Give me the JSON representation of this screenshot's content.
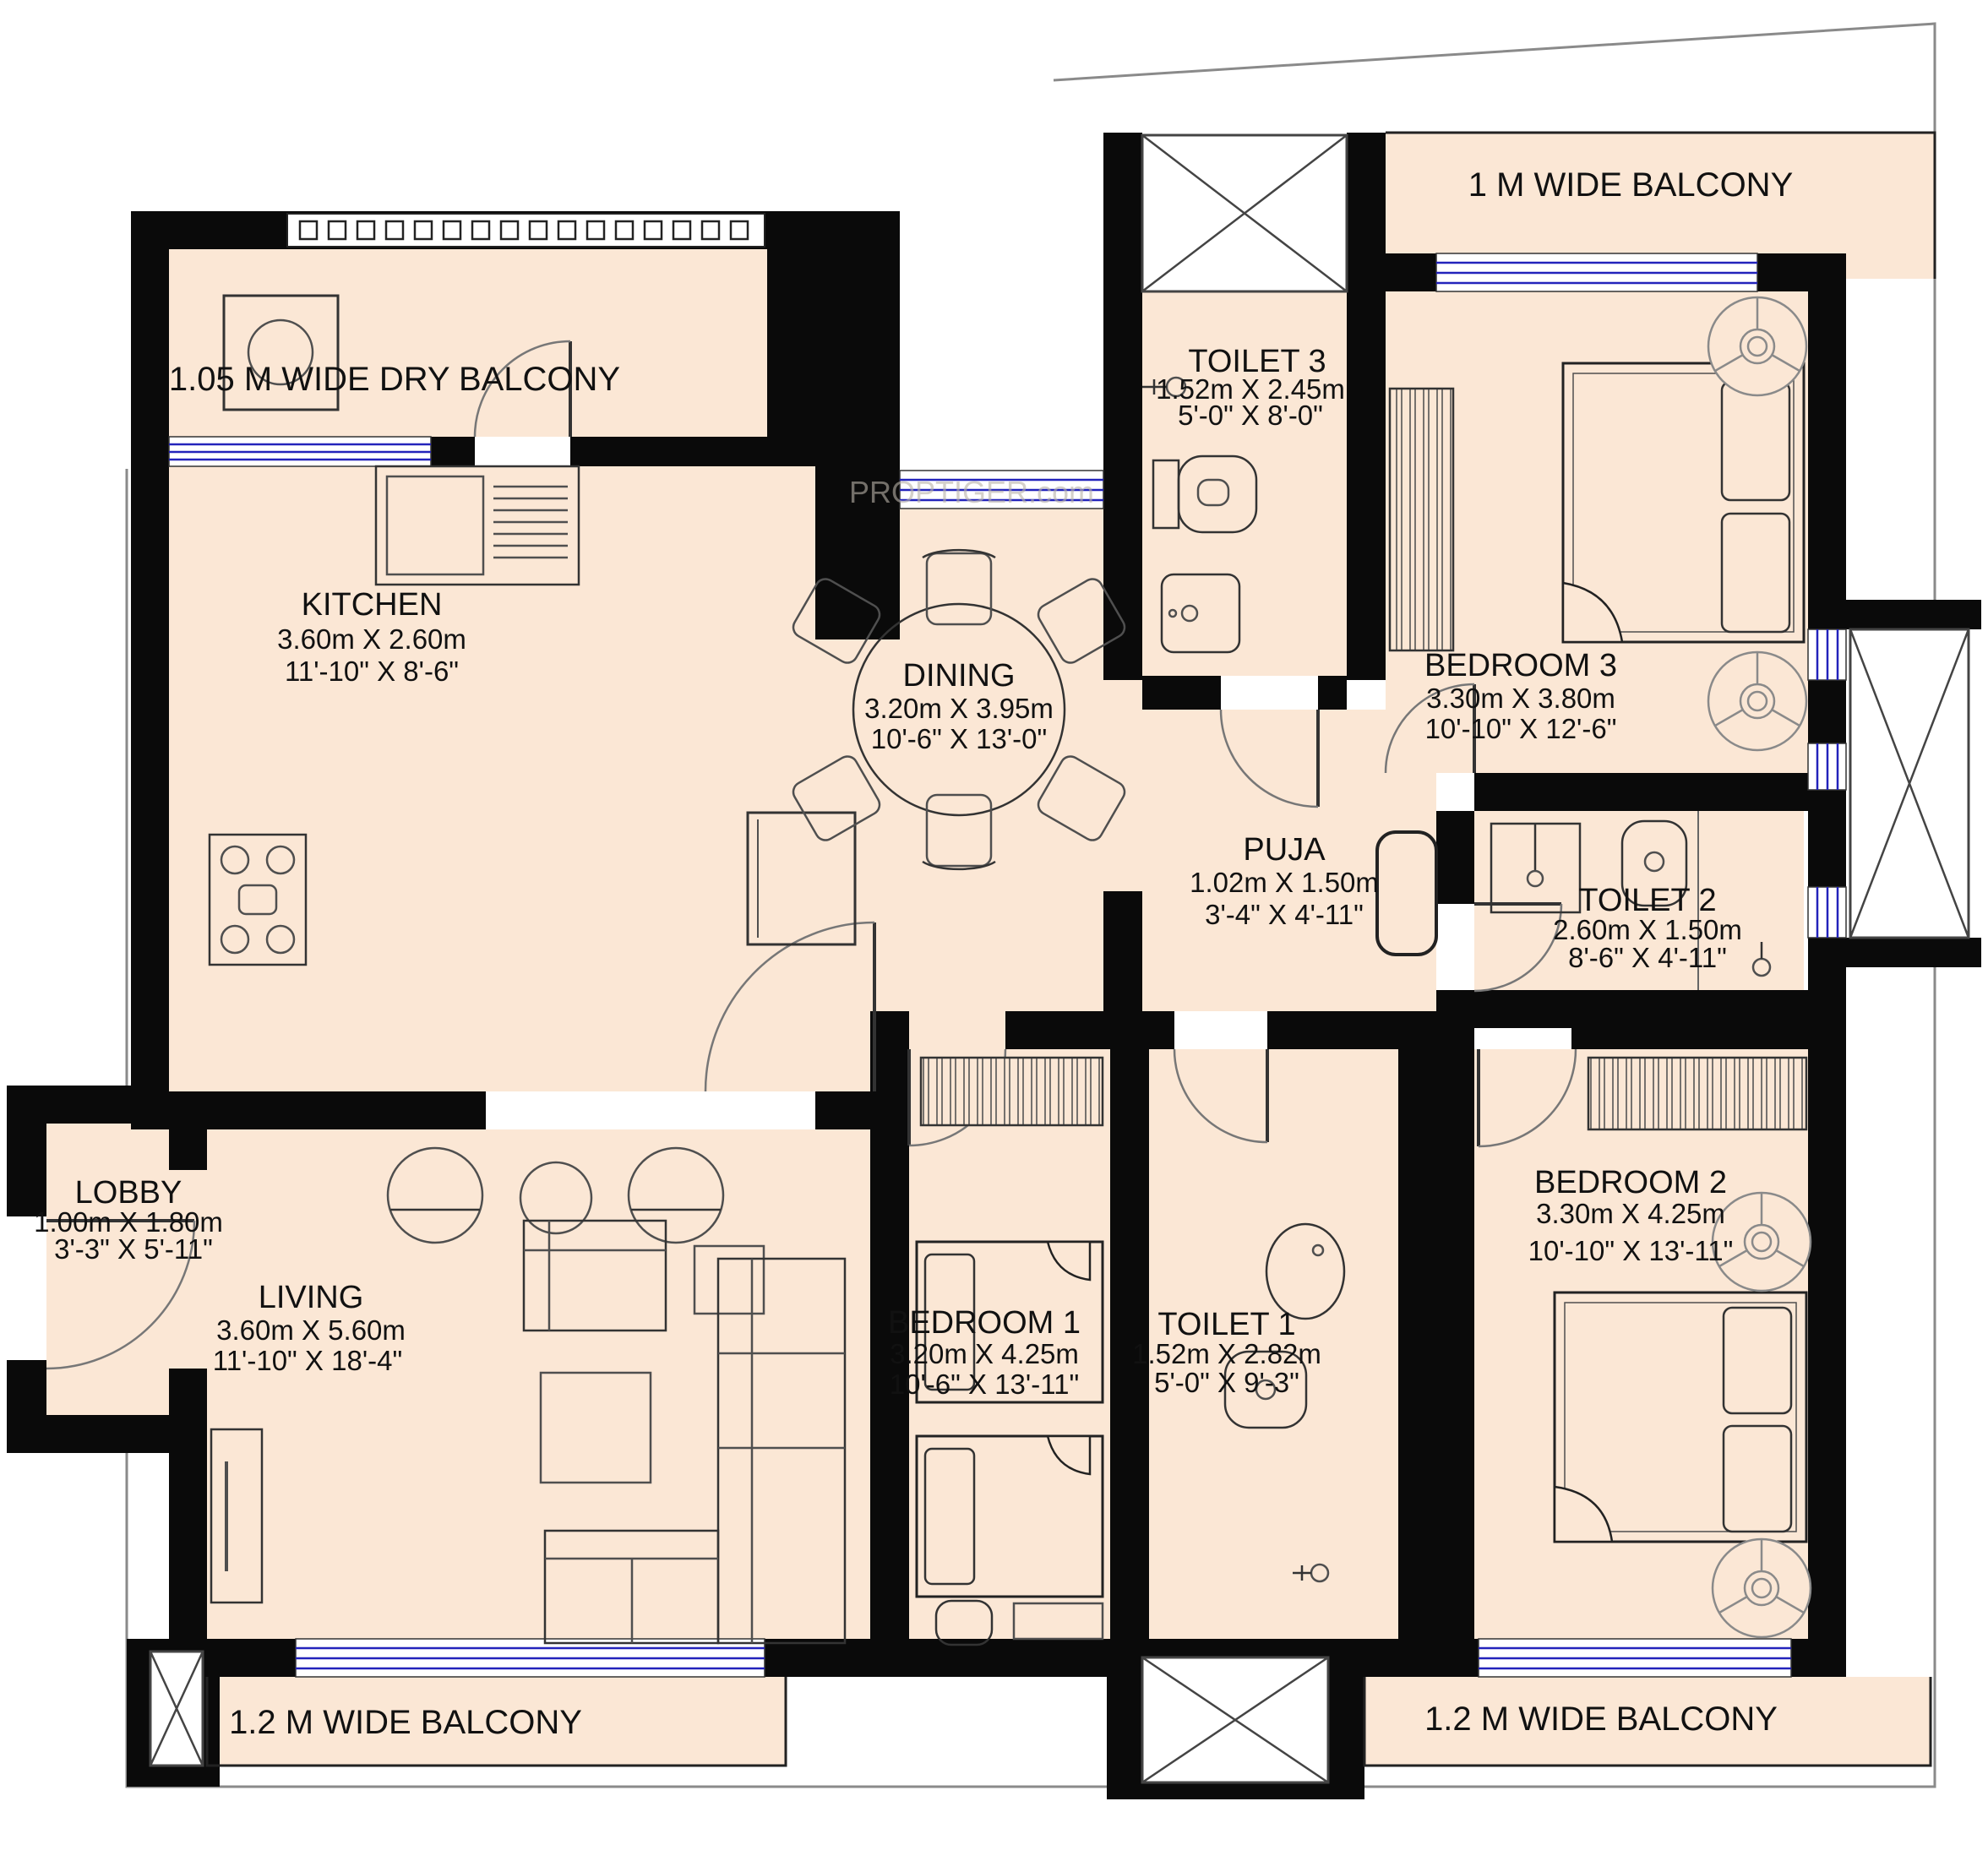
{
  "plan": {
    "watermark": "PROPTIGER.com",
    "colors": {
      "floor": "#fbe7d5",
      "wall": "#0a0a0a",
      "window_blue": "#2323bb",
      "outline_gray": "#8a8a8a",
      "furniture_stroke": "#4f4f4f"
    },
    "rooms": [
      {
        "id": "dry-balcony",
        "name": "1.05 M WIDE DRY BALCONY",
        "size_m": "",
        "size_ft": ""
      },
      {
        "id": "kitchen",
        "name": "KITCHEN",
        "size_m": "3.60m X 2.60m",
        "size_ft": "11'-10\" X 8'-6\""
      },
      {
        "id": "dining",
        "name": "DINING",
        "size_m": "3.20m X 3.95m",
        "size_ft": "10'-6\" X 13'-0\""
      },
      {
        "id": "toilet-3",
        "name": "TOILET 3",
        "size_m": "1.52m X 2.45m",
        "size_ft": "5'-0\" X 8'-0\""
      },
      {
        "id": "balcony-top",
        "name": "1 M WIDE BALCONY",
        "size_m": "",
        "size_ft": ""
      },
      {
        "id": "bedroom-3",
        "name": "BEDROOM 3",
        "size_m": "3.30m X 3.80m",
        "size_ft": "10'-10\" X 12'-6\""
      },
      {
        "id": "puja",
        "name": "PUJA",
        "size_m": "1.02m X 1.50m",
        "size_ft": "3'-4\" X 4'-11\""
      },
      {
        "id": "toilet-2",
        "name": "TOILET 2",
        "size_m": "2.60m X 1.50m",
        "size_ft": "8'-6\" X 4'-11\""
      },
      {
        "id": "lobby",
        "name": "LOBBY",
        "size_m": "1.00m X 1.80m",
        "size_ft": "3'-3\" X 5'-11\""
      },
      {
        "id": "living",
        "name": "LIVING",
        "size_m": "3.60m X 5.60m",
        "size_ft": "11'-10\" X 18'-4\""
      },
      {
        "id": "bedroom-1",
        "name": "BEDROOM 1",
        "size_m": "3.20m X 4.25m",
        "size_ft": "10'-6\" X 13'-11\""
      },
      {
        "id": "toilet-1",
        "name": "TOILET 1",
        "size_m": "1.52m X 2.82m",
        "size_ft": "5'-0\" X 9'-3\""
      },
      {
        "id": "bedroom-2",
        "name": "BEDROOM 2",
        "size_m": "3.30m X 4.25m",
        "size_ft": "10'-10\" X 13'-11\""
      },
      {
        "id": "balcony-left",
        "name": "1.2 M WIDE BALCONY",
        "size_m": "",
        "size_ft": ""
      },
      {
        "id": "balcony-right",
        "name": "1.2 M WIDE BALCONY",
        "size_m": "",
        "size_ft": ""
      }
    ]
  }
}
